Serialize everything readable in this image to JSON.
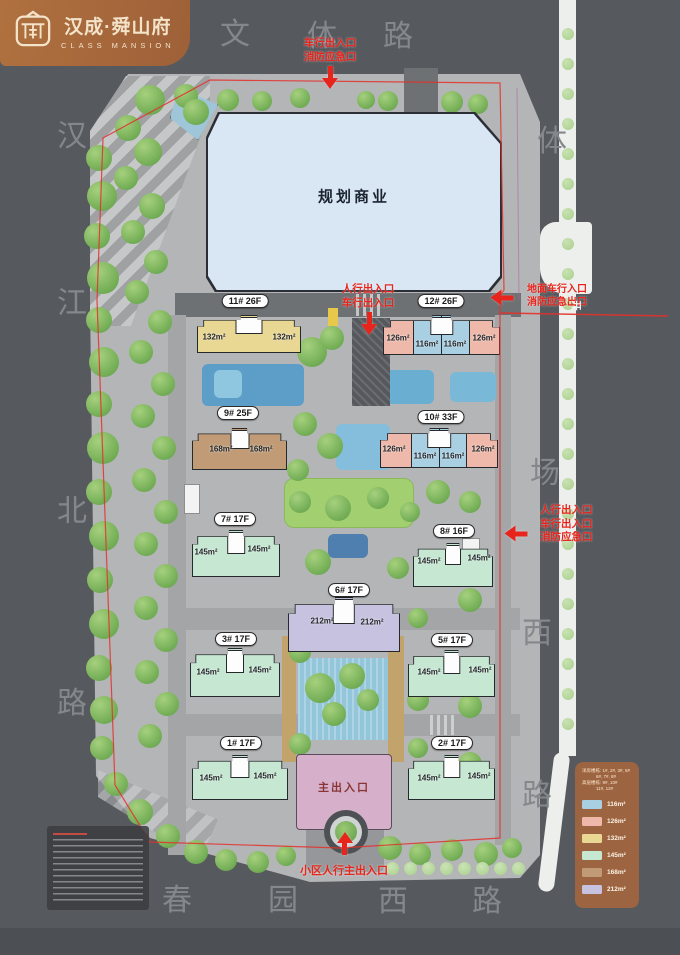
{
  "logo": {
    "title": "汉成·舜山府",
    "subtitle": "CLASS MANSION"
  },
  "site": {
    "commercial_label": "规划商业",
    "main_entrance_label": "主出入口"
  },
  "streets": {
    "top": [
      "文",
      "体",
      "路"
    ],
    "left": [
      "汉",
      "江",
      "北",
      "路"
    ],
    "right": [
      "体",
      "场",
      "西",
      "路"
    ],
    "bottom": [
      "春",
      "园",
      "西",
      "路"
    ]
  },
  "annotations": {
    "top_gate": [
      "车行出入口",
      "消防应急口"
    ],
    "mid_gate": [
      "人行出入口",
      "车行出入口"
    ],
    "right_upper_gate": [
      "地面车行入口",
      "消防应急出口"
    ],
    "right_upper_side_char": "开",
    "right_mid_gate": [
      "人行出入口",
      "车行出入口",
      "消防应急口"
    ],
    "bottom_gate": "小区人行主出入口"
  },
  "buildings": [
    {
      "name": "11# 26F",
      "units": [
        "132m²",
        "132m²"
      ]
    },
    {
      "name": "12# 26F",
      "units": [
        "126m²",
        "116m²",
        "116m²",
        "126m²"
      ]
    },
    {
      "name": "9# 25F",
      "units": [
        "168m²",
        "168m²"
      ]
    },
    {
      "name": "10# 33F",
      "units": [
        "126m²",
        "116m²",
        "116m²",
        "126m²"
      ]
    },
    {
      "name": "7# 17F",
      "units": [
        "145m²",
        "145m²"
      ]
    },
    {
      "name": "8# 16F",
      "units": [
        "145m²",
        "145m²"
      ]
    },
    {
      "name": "6# 17F",
      "units": [
        "212m²",
        "212m²"
      ]
    },
    {
      "name": "3# 17F",
      "units": [
        "145m²",
        "145m²"
      ]
    },
    {
      "name": "5# 17F",
      "units": [
        "145m²",
        "145m²"
      ]
    },
    {
      "name": "1# 17F",
      "units": [
        "145m²",
        "145m²"
      ]
    },
    {
      "name": "2# 17F",
      "units": [
        "145m²",
        "145m²"
      ]
    }
  ],
  "legend": {
    "header_lines": [
      "洋房楼栋: 1#, 2#, 3#, 5#",
      "6#, 7#, 8#",
      "高层楼栋: 9#, 10#",
      "11#, 12#"
    ],
    "items": [
      {
        "label": "116m²",
        "color": "#a9cfe3"
      },
      {
        "label": "126m²",
        "color": "#eeb9aa"
      },
      {
        "label": "132m²",
        "color": "#e9d794"
      },
      {
        "label": "145m²",
        "color": "#c6e7d2"
      },
      {
        "label": "168m²",
        "color": "#c09b76"
      },
      {
        "label": "212m²",
        "color": "#c7c2e0"
      }
    ]
  },
  "colors": {
    "background": "#565a5e",
    "logo_brown": "#a86a3e",
    "legend_brown": "#9c6440",
    "accent_red": "#e8251c",
    "commercial_fill": "#d9e7f5"
  }
}
